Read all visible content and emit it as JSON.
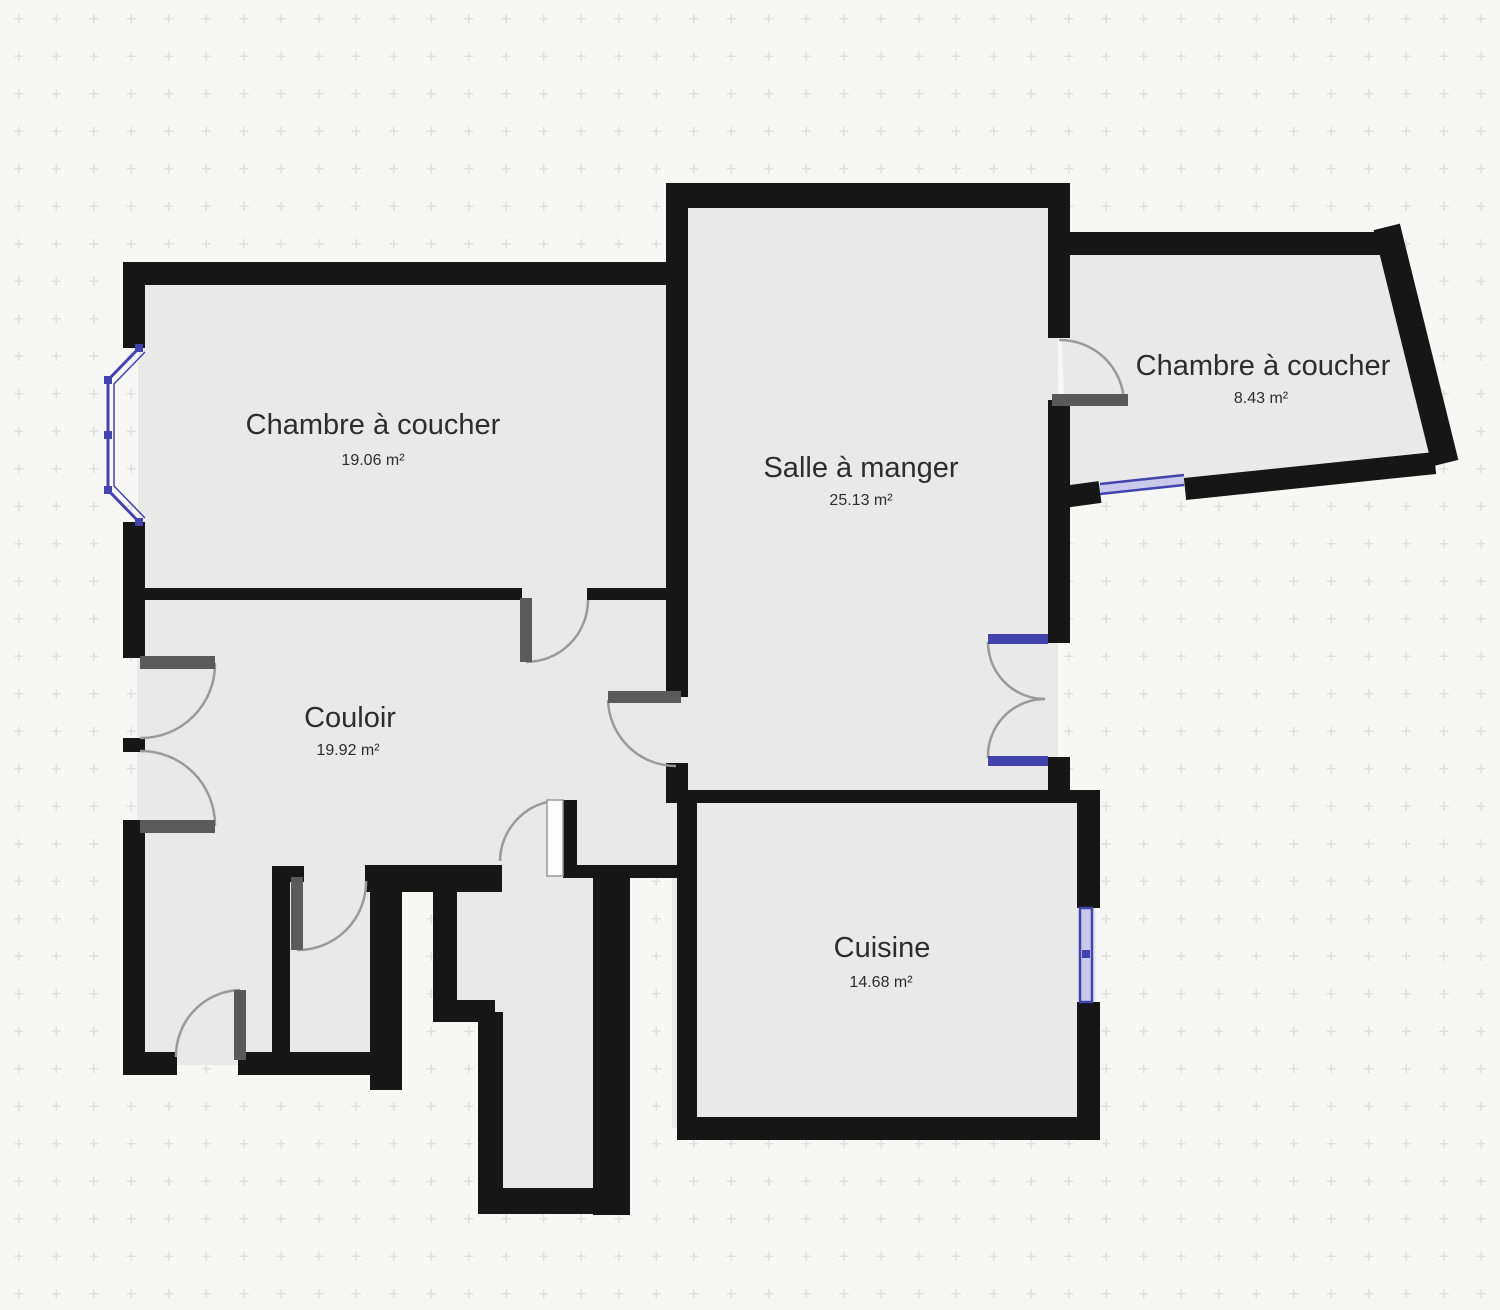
{
  "plan": {
    "title": "Floor plan",
    "rooms": [
      {
        "name": "bedroom-top-left",
        "label": "Chambre à coucher",
        "area": "19.06 m²"
      },
      {
        "name": "dining-room",
        "label": "Salle à manger",
        "area": "25.13 m²"
      },
      {
        "name": "bedroom-top-right",
        "label": "Chambre à coucher",
        "area": "8.43 m²"
      },
      {
        "name": "hallway",
        "label": "Couloir",
        "area": "19.92 m²"
      },
      {
        "name": "kitchen",
        "label": "Cuisine",
        "area": "14.68 m²"
      }
    ],
    "colors": {
      "background": "#f7f7f6",
      "grid_dot": "#e0e0e0",
      "floor": "#e9e9e9",
      "wall": "#161616",
      "door_leaf": "#5a5a5a",
      "arc": "#9a9a9a",
      "window": "#4343ae",
      "window_fill": "#c9c9ec",
      "label": "#2d2d2d"
    }
  }
}
